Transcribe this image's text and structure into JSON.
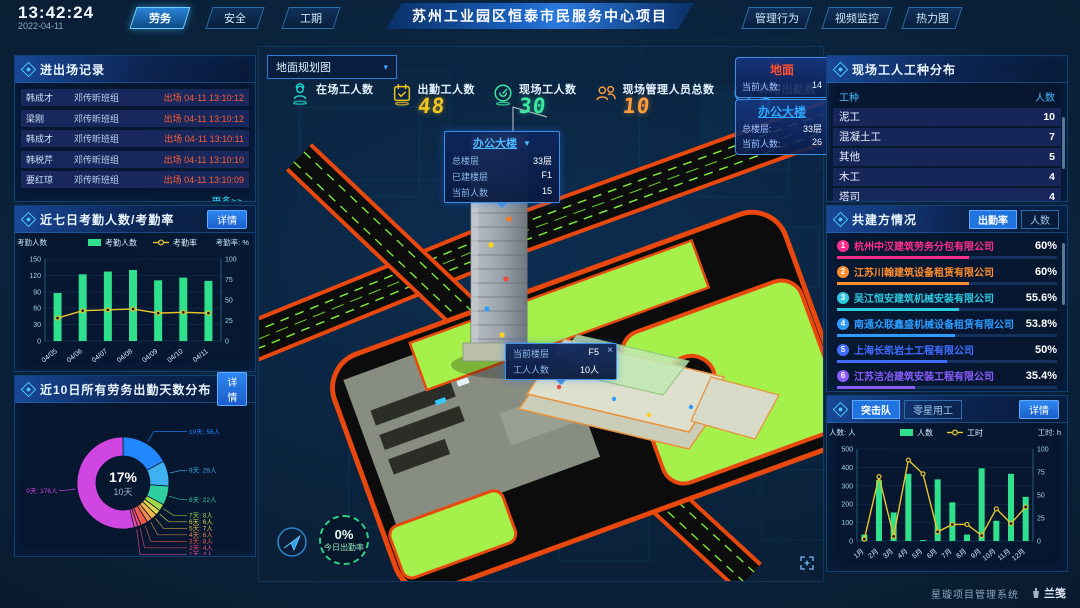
{
  "header": {
    "time": "13:42:24",
    "date": "2022-04-11",
    "tabs_left": [
      {
        "label": "劳务",
        "active": true
      },
      {
        "label": "安全",
        "active": false
      },
      {
        "label": "工期",
        "active": false
      }
    ],
    "title": "苏州工业园区恒泰市民服务中心项目",
    "tabs_right": [
      "管理行为",
      "视频监控",
      "热力图"
    ]
  },
  "entry_exit": {
    "title": "进出场记录",
    "rows": [
      {
        "name": "韩成才",
        "team": "邓传昕班组",
        "event": "出场 04-11 13:10:12"
      },
      {
        "name": "梁刚",
        "team": "邓传昕班组",
        "event": "出场 04-11 13:10:12"
      },
      {
        "name": "韩成才",
        "team": "邓传昕班组",
        "event": "出场 04-11 13:10:11"
      },
      {
        "name": "韩税芹",
        "team": "邓传昕班组",
        "event": "出场 04-11 13:10:10"
      },
      {
        "name": "要红琼",
        "team": "邓传昕班组",
        "event": "出场 04-11 13:10:09"
      }
    ],
    "more_label": "更多>>"
  },
  "attendance7": {
    "title": "近七日考勤人数/考勤率",
    "detail_label": "详情",
    "chart_data": {
      "type": "bar+line",
      "categories": [
        "04/05",
        "04/06",
        "04/07",
        "04/08",
        "04/09",
        "04/10",
        "04/11"
      ],
      "series": [
        {
          "name": "考勤人数",
          "type": "bar",
          "axis": "left",
          "color": "#2fe08d",
          "values": [
            88,
            122,
            127,
            130,
            111,
            116,
            110
          ]
        },
        {
          "name": "考勤率",
          "type": "line",
          "axis": "right",
          "color": "#e8c52a",
          "values": [
            28,
            37,
            38,
            39,
            34,
            35,
            34
          ]
        }
      ],
      "y_left": {
        "label": "考勤人数",
        "max": 150,
        "ticks": [
          0,
          30,
          60,
          90,
          120,
          150
        ]
      },
      "y_right": {
        "label": "考勤率: %",
        "max": 100,
        "ticks": [
          0,
          25,
          50,
          75,
          100
        ]
      },
      "legend_position": "top"
    }
  },
  "distribution10": {
    "title": "近10日所有劳务出勤天数分布",
    "detail_label": "详情",
    "chart_data": {
      "type": "pie",
      "center": {
        "value": "17%",
        "label": "10天"
      },
      "slices": [
        {
          "label": "10天",
          "count": "56人",
          "value": 56,
          "color": "#2288ff"
        },
        {
          "label": "9天",
          "count": "29人",
          "value": 29,
          "color": "#3fb0f0"
        },
        {
          "label": "8天",
          "count": "22人",
          "value": 22,
          "color": "#2ed0a0"
        },
        {
          "label": "7天",
          "count": "8人",
          "value": 8,
          "color": "#a0d84a"
        },
        {
          "label": "6天",
          "count": "6人",
          "value": 6,
          "color": "#e0d84a"
        },
        {
          "label": "5天",
          "count": "7人",
          "value": 7,
          "color": "#f0b84a"
        },
        {
          "label": "4天",
          "count": "6人",
          "value": 6,
          "color": "#f0884a"
        },
        {
          "label": "3天",
          "count": "8人",
          "value": 8,
          "color": "#f05a4a"
        },
        {
          "label": "2天",
          "count": "4人",
          "value": 4,
          "color": "#f04a7a"
        },
        {
          "label": "1天",
          "count": "4人",
          "value": 4,
          "color": "#ee4aa2"
        },
        {
          "label": "0天",
          "count": "176人",
          "value": 176,
          "color": "#cf46e0"
        }
      ]
    }
  },
  "map": {
    "layer_select": "地面规划图",
    "stats": [
      {
        "label": "在场工人数",
        "value": "",
        "icon": "worker-icon",
        "color": "#23d5c8"
      },
      {
        "label": "出勤工人数",
        "value": "48",
        "icon": "calendar-icon",
        "color": "#f2c51d"
      },
      {
        "label": "现场工人数",
        "value": "30",
        "icon": "gauge-icon",
        "color": "#3ce8a0"
      },
      {
        "label": "现场管理人员总数",
        "value": "10",
        "icon": "people-icon",
        "color": "#ff9d3c"
      },
      {
        "label": "异常出勤数",
        "value": "0",
        "icon": "pulse-icon",
        "color": "#28a7ff"
      }
    ],
    "building_popup": {
      "title": "办公大楼",
      "rows": [
        [
          "总楼层",
          "33层"
        ],
        [
          "已建楼层",
          "F1"
        ],
        [
          "当前人数",
          "15"
        ]
      ]
    },
    "floor_popup": {
      "rows": [
        [
          "当前楼层",
          "F5"
        ],
        [
          "工人人数",
          "10人"
        ]
      ],
      "close": "×"
    },
    "cards": [
      {
        "title": "地面",
        "title_color": "#ff4d2e",
        "rows": [
          [
            "当前人数:",
            "14"
          ]
        ]
      },
      {
        "title": "办公大楼",
        "title_color": "#2ea8ff",
        "rows": [
          [
            "总楼层:",
            "33层"
          ],
          [
            "当前人数:",
            "26"
          ]
        ]
      }
    ],
    "attendance_badge": {
      "value": "0%",
      "label": "今日出勤率"
    }
  },
  "worker_types": {
    "title": "现场工人工种分布",
    "columns": [
      "工种",
      "人数"
    ],
    "rows": [
      [
        "泥工",
        "10"
      ],
      [
        "混凝土工",
        "7"
      ],
      [
        "其他",
        "5"
      ],
      [
        "木工",
        "4"
      ],
      [
        "塔司",
        "4"
      ]
    ]
  },
  "partners": {
    "title": "共建方情况",
    "tabs": [
      "出勤率",
      "人数"
    ],
    "active_tab": 0,
    "items": [
      {
        "rank": "1",
        "name": "杭州中汉建筑劳务分包有限公司",
        "value": "60%",
        "pct": 60,
        "color": "#ff2e8d"
      },
      {
        "rank": "2",
        "name": "江苏川翰建筑设备租赁有限公司",
        "value": "60%",
        "pct": 60,
        "color": "#ff8c2e"
      },
      {
        "rank": "3",
        "name": "吴江恒安建筑机械安装有限公司",
        "value": "55.6%",
        "pct": 55.6,
        "color": "#2ec9e0"
      },
      {
        "rank": "4",
        "name": "南通众联鑫盛机械设备租赁有限公司",
        "value": "53.8%",
        "pct": 53.8,
        "color": "#2e9bff"
      },
      {
        "rank": "5",
        "name": "上海长凯岩土工程有限公司",
        "value": "50%",
        "pct": 50,
        "color": "#3f6dff"
      },
      {
        "rank": "6",
        "name": "江苏洁冶建筑安装工程有限公司",
        "value": "35.4%",
        "pct": 35.4,
        "color": "#8a5cff"
      }
    ]
  },
  "squad": {
    "tabs": [
      "突击队",
      "零星用工"
    ],
    "active_tab": 0,
    "detail_label": "详情",
    "chart_data": {
      "type": "bar+line",
      "categories": [
        "1月",
        "2月",
        "3月",
        "4月",
        "5月",
        "6月",
        "7月",
        "8月",
        "9月",
        "10月",
        "11月",
        "12月"
      ],
      "series": [
        {
          "name": "人数",
          "type": "bar",
          "axis": "left",
          "color": "#2fe08d",
          "values": [
            35,
            330,
            155,
            365,
            5,
            335,
            210,
            35,
            395,
            110,
            365,
            240
          ]
        },
        {
          "name": "工时",
          "type": "line",
          "axis": "right",
          "color": "#e8c52a",
          "values": [
            2,
            70,
            5,
            88,
            73,
            10,
            18,
            18,
            6,
            35,
            19,
            37
          ]
        }
      ],
      "y_left": {
        "label": "人数: 人",
        "max": 500,
        "ticks": [
          0,
          100,
          200,
          300,
          400,
          500
        ]
      },
      "y_right": {
        "label": "工时: h",
        "max": 100,
        "ticks": [
          0,
          25,
          50,
          75,
          100
        ]
      },
      "legend_position": "top"
    }
  },
  "footer": {
    "system_name": "星璇项目管理系统",
    "logo_text": "兰笺"
  }
}
